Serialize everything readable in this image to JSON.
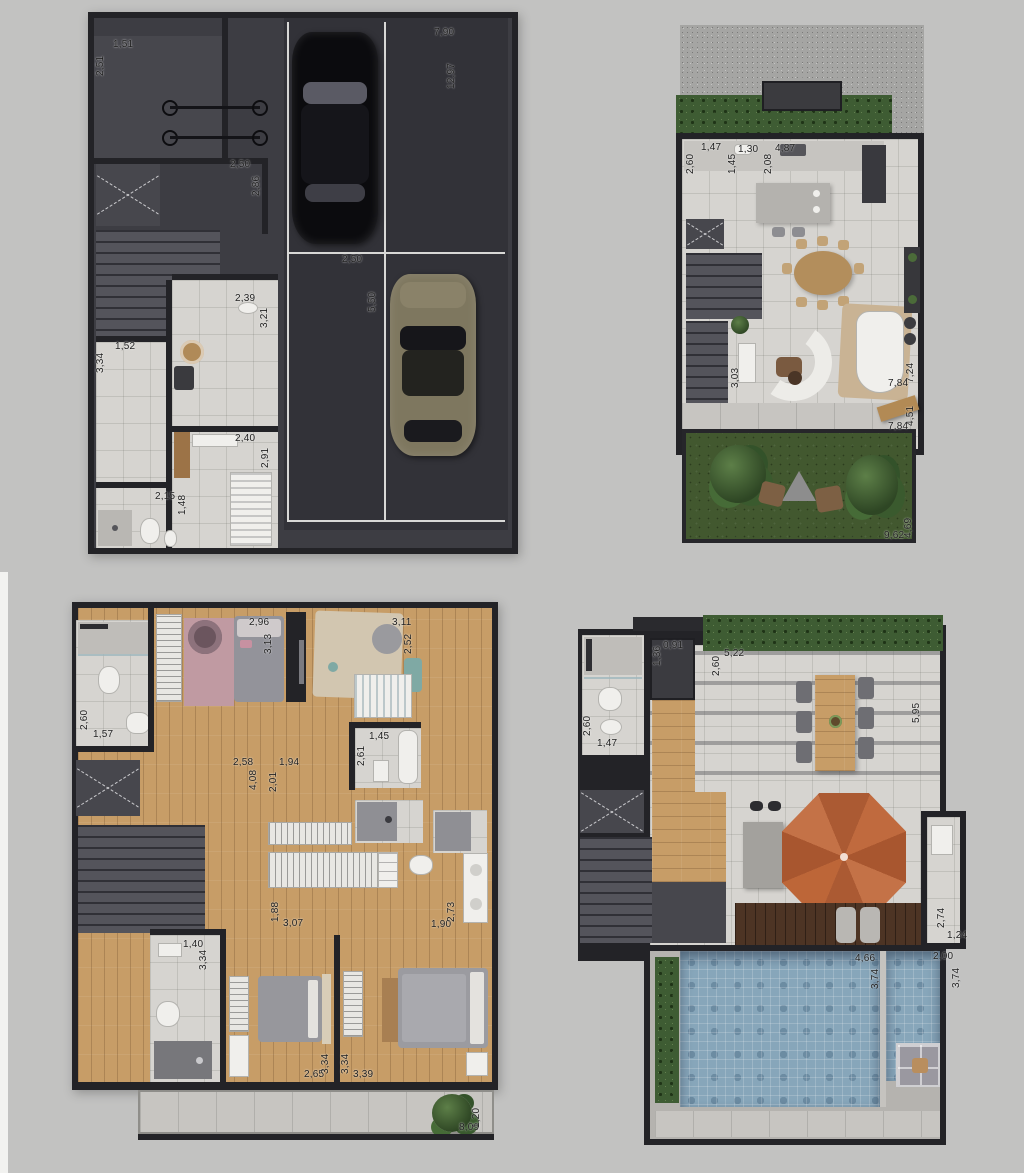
{
  "document": {
    "type": "architectural-floor-plans",
    "views": [
      "garage-level",
      "living-level",
      "bedrooms-level",
      "rooftop-level"
    ],
    "unit_style": "meters-comma-decimal"
  },
  "palette": {
    "background": "#c2c2c1",
    "wall": "#232327",
    "dark_floor": "#3d3d43",
    "light_tile": "#d6d4d0",
    "wood_floor": "#c79d67",
    "dark_deck": "#4d3424",
    "grass": "#42582f",
    "hedge": "#3e5c33",
    "pool_water": "#87a6ba",
    "umbrella": "#c06a3e",
    "dimension_text": "#1e1e1e"
  },
  "icons": {
    "car_black": "css-shape",
    "car_gold": "css-shape",
    "bicycle": "css-shape",
    "stairs": "css-stripes",
    "elevator-shaft-x": "css-dashed-x",
    "umbrella": "css-octagon",
    "bush": "css-radial-blob"
  },
  "plans": {
    "garage": {
      "dims": [
        "1,51",
        "2,51",
        "2,50",
        "2,86",
        "7,90",
        "12,97",
        "2,50",
        "5,50",
        "2,39",
        "3,21",
        "1,52",
        "3,34",
        "2,40",
        "2,91",
        "2,15",
        "1,48"
      ]
    },
    "living": {
      "dims": [
        "1,47",
        "2,60",
        "1,30",
        "1,45",
        "4,87",
        "2,08",
        "3,03",
        "7,24",
        "7,84",
        "4,51",
        "7,84",
        "4,69",
        "9,62"
      ]
    },
    "bedrooms": {
      "dims": [
        "1,57",
        "2,60",
        "2,96",
        "3,13",
        "3,11",
        "2,52",
        "1,45",
        "2,61",
        "2,58",
        "4,08",
        "1,94",
        "2,01",
        "1,88",
        "3,07",
        "1,90",
        "2,73",
        "1,40",
        "3,34",
        "2,65",
        "3,34",
        "3,39",
        "3,34",
        "8,09",
        "1,20"
      ]
    },
    "roof": {
      "dims": [
        "0,91",
        "1,36",
        "5,22",
        "2,60",
        "5,95",
        "1,47",
        "2,60",
        "2,74",
        "1,24",
        "4,66",
        "3,74",
        "2,00",
        "3,74"
      ]
    }
  }
}
